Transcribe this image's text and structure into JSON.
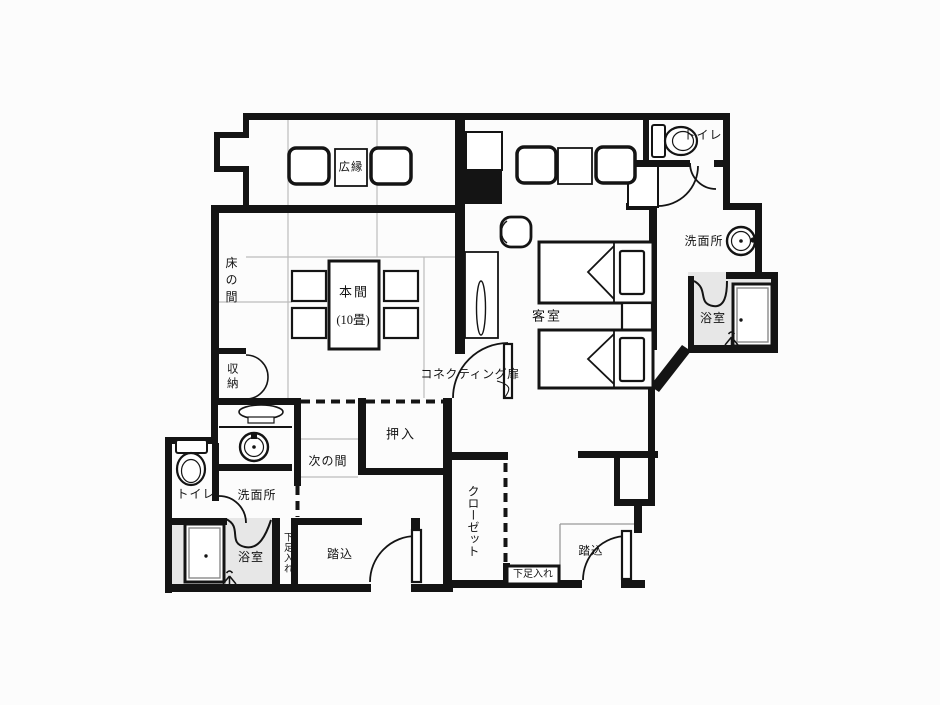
{
  "colors": {
    "wall": "#141414",
    "background": "#fcfcfc",
    "bath_floor": "#e7e7e7",
    "tatami_line": "#bcbcbc",
    "step_line": "#999999",
    "tub_inner": "#8a8a8a"
  },
  "rooms": {
    "hiroen": {
      "label": "広縁"
    },
    "honma": {
      "label": "本間",
      "size_label": "(10畳)"
    },
    "tokonoma": {
      "label": "床の間"
    },
    "shunou": {
      "label": "収納"
    },
    "tsuginoma": {
      "label": "次の間"
    },
    "oshiire": {
      "label": "押入"
    },
    "kyakushitsu": {
      "label": "客室"
    },
    "closet": {
      "label": "クローゼット"
    },
    "toilet_left": {
      "label": "トイレ"
    },
    "senmenjo_left": {
      "label": "洗面所"
    },
    "yokushitsu_left": {
      "label": "浴室"
    },
    "getabako_left": {
      "label": "下足入れ"
    },
    "fumikomi_left": {
      "label": "踏込"
    },
    "toilet_right": {
      "label": "トイレ"
    },
    "senmenjo_right": {
      "label": "洗面所"
    },
    "yokushitsu_right": {
      "label": "浴室"
    },
    "getabako_right": {
      "label": "下足入れ"
    },
    "fumikomi_right": {
      "label": "踏込"
    },
    "connecting_door": {
      "label": "コネクティング扉"
    }
  }
}
